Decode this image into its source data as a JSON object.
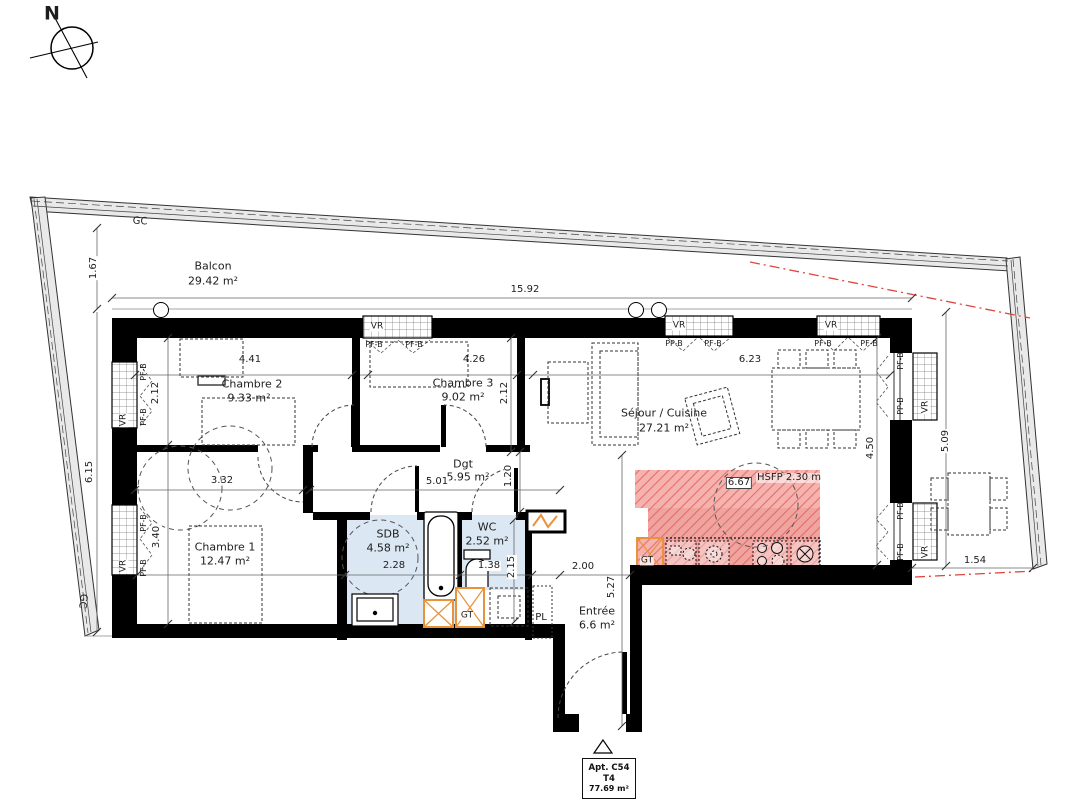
{
  "title_block": {
    "apartment": "Apt. C54",
    "unit_type": "T4",
    "total_area": "77.69 m²"
  },
  "colors": {
    "wall": "#000000",
    "wet_room_fill": "#dbe7f3",
    "kitchen_zone_fill": "#f5b2ae",
    "kitchen_hatch_line": "#e2716c",
    "technical_orange": "#e8923a",
    "alignment_red": "#e0443e",
    "balcony_band_fill": "#e9e9e9"
  },
  "rooms": [
    {
      "name": "Balcon",
      "area": "29.42 m²"
    },
    {
      "name": "Chambre 2",
      "area": "9.33 m²"
    },
    {
      "name": "Chambre 3",
      "area": "9.02 m²"
    },
    {
      "name": "Séjour / Cuisine",
      "area": "27.21 m²"
    },
    {
      "name": "Chambre 1",
      "area": "12.47 m²"
    },
    {
      "name": "Dgt",
      "area": "5.95 m²"
    },
    {
      "name": "SDB",
      "area": "4.58 m²"
    },
    {
      "name": "WC",
      "area": "2.52 m²"
    },
    {
      "name": "Entrée",
      "area": "6.6 m²"
    }
  ],
  "labels": [
    {
      "id": "north",
      "t": "N",
      "x": 52,
      "y": 14,
      "fs": 19,
      "bold": true
    },
    {
      "id": "gc-top",
      "t": "GC",
      "x": 140,
      "y": 222,
      "fs": 10,
      "rot": 4
    },
    {
      "id": "gc-left",
      "t": "GC",
      "x": 82,
      "y": 601,
      "fs": 10,
      "rot": 97
    },
    {
      "id": "balcon-name",
      "t": "Balcon",
      "x": 213,
      "y": 266,
      "fs": 11
    },
    {
      "id": "balcon-area",
      "t": "29.42 m²",
      "x": 213,
      "y": 281,
      "fs": 11
    },
    {
      "id": "dim-1-67",
      "t": "1.67",
      "x": 94,
      "y": 268,
      "fs": 10,
      "rot": -90,
      "bg": "#fff"
    },
    {
      "id": "dim-15-92",
      "t": "15.92",
      "x": 525,
      "y": 290,
      "fs": 10
    },
    {
      "id": "dim-6-15",
      "t": "6.15",
      "x": 90,
      "y": 472,
      "fs": 10,
      "rot": -90,
      "bg": "#fff"
    },
    {
      "id": "vr-top-1",
      "t": "VR",
      "x": 377,
      "y": 327,
      "fs": 9,
      "bg": "#fff"
    },
    {
      "id": "vr-top-2",
      "t": "VR",
      "x": 679,
      "y": 326,
      "fs": 9,
      "bg": "#fff"
    },
    {
      "id": "vr-top-3",
      "t": "VR",
      "x": 831,
      "y": 326,
      "fs": 9,
      "bg": "#fff"
    },
    {
      "id": "vr-left-1",
      "t": "VR",
      "x": 124,
      "y": 420,
      "fs": 9,
      "rot": -90,
      "bg": "#fff"
    },
    {
      "id": "vr-left-2",
      "t": "VR",
      "x": 124,
      "y": 566,
      "fs": 9,
      "rot": -90,
      "bg": "#fff"
    },
    {
      "id": "vr-right-1",
      "t": "VR",
      "x": 926,
      "y": 407,
      "fs": 9,
      "rot": -90,
      "bg": "#fff"
    },
    {
      "id": "vr-right-2",
      "t": "VR",
      "x": 926,
      "y": 552,
      "fs": 9,
      "rot": -90,
      "bg": "#fff"
    },
    {
      "id": "pfb-t1a",
      "t": "PF-B",
      "x": 374,
      "y": 345,
      "fs": 8
    },
    {
      "id": "pfb-t1b",
      "t": "PF-B",
      "x": 414,
      "y": 345,
      "fs": 8
    },
    {
      "id": "ppb-t2a",
      "t": "PP-B",
      "x": 674,
      "y": 344,
      "fs": 8
    },
    {
      "id": "pfb-t2b",
      "t": "PF-B",
      "x": 713,
      "y": 344,
      "fs": 8
    },
    {
      "id": "pfb-t3a",
      "t": "PF-B",
      "x": 823,
      "y": 344,
      "fs": 8
    },
    {
      "id": "pfb-t3b",
      "t": "PF-B",
      "x": 869,
      "y": 344,
      "fs": 8
    },
    {
      "id": "pfb-l1a",
      "t": "PF-B",
      "x": 144,
      "y": 372,
      "fs": 8,
      "rot": -90
    },
    {
      "id": "pfb-l1b",
      "t": "PF-B",
      "x": 144,
      "y": 417,
      "fs": 8,
      "rot": -90
    },
    {
      "id": "pfb-l2a",
      "t": "PF-B",
      "x": 144,
      "y": 523,
      "fs": 8,
      "rot": -90
    },
    {
      "id": "pfb-l2b",
      "t": "PF-B",
      "x": 144,
      "y": 568,
      "fs": 8,
      "rot": -90
    },
    {
      "id": "pfb-r1a",
      "t": "PF-B",
      "x": 901,
      "y": 361,
      "fs": 8,
      "rot": -90
    },
    {
      "id": "ppb-r1b",
      "t": "PP-B",
      "x": 901,
      "y": 406,
      "fs": 8,
      "rot": -90
    },
    {
      "id": "pfb-r2a",
      "t": "PF-B",
      "x": 901,
      "y": 511,
      "fs": 8,
      "rot": -90
    },
    {
      "id": "pfb-r2b",
      "t": "PF-B",
      "x": 901,
      "y": 552,
      "fs": 8,
      "rot": -90
    },
    {
      "id": "ch2-name",
      "t": "Chambre 2",
      "x": 252,
      "y": 384,
      "fs": 11
    },
    {
      "id": "ch2-area",
      "t": "9.33 m²",
      "x": 249,
      "y": 398,
      "fs": 11
    },
    {
      "id": "dim-4-41",
      "t": "4.41",
      "x": 250,
      "y": 360,
      "fs": 10
    },
    {
      "id": "dim-2-12a",
      "t": "2.12",
      "x": 156,
      "y": 393,
      "fs": 10,
      "rot": -90
    },
    {
      "id": "ch3-name",
      "t": "Chambre 3",
      "x": 463,
      "y": 383,
      "fs": 11
    },
    {
      "id": "ch3-area",
      "t": "9.02 m²",
      "x": 463,
      "y": 397,
      "fs": 11
    },
    {
      "id": "dim-4-26",
      "t": "4.26",
      "x": 474,
      "y": 360,
      "fs": 10
    },
    {
      "id": "dim-2-12b",
      "t": "2.12",
      "x": 505,
      "y": 393,
      "fs": 10,
      "rot": -90
    },
    {
      "id": "sejour-name",
      "t": "Séjour / Cuisine",
      "x": 664,
      "y": 413,
      "fs": 11
    },
    {
      "id": "sejour-area",
      "t": "27.21 m²",
      "x": 664,
      "y": 428,
      "fs": 11
    },
    {
      "id": "dim-6-23",
      "t": "6.23",
      "x": 750,
      "y": 360,
      "fs": 10
    },
    {
      "id": "dim-4-50",
      "t": "4.50",
      "x": 871,
      "y": 448,
      "fs": 10,
      "rot": -90,
      "bg": "#fff"
    },
    {
      "id": "ch1-name",
      "t": "Chambre 1",
      "x": 225,
      "y": 547,
      "fs": 11
    },
    {
      "id": "ch1-area",
      "t": "12.47 m²",
      "x": 225,
      "y": 561,
      "fs": 11
    },
    {
      "id": "dim-3-32",
      "t": "3.32",
      "x": 222,
      "y": 481,
      "fs": 10
    },
    {
      "id": "dim-3-40",
      "t": "3.40",
      "x": 157,
      "y": 537,
      "fs": 10,
      "rot": -90,
      "bg": "#fff"
    },
    {
      "id": "dgt-name",
      "t": "Dgt",
      "x": 463,
      "y": 464,
      "fs": 11
    },
    {
      "id": "dgt-area",
      "t": "5.95 m²",
      "x": 468,
      "y": 477,
      "fs": 11
    },
    {
      "id": "dim-5-01",
      "t": "5.01",
      "x": 437,
      "y": 482,
      "fs": 10,
      "bg": "#fff"
    },
    {
      "id": "dim-1-20",
      "t": "1.20",
      "x": 509,
      "y": 476,
      "fs": 10,
      "rot": -90,
      "bg": "#fff"
    },
    {
      "id": "sdb-name",
      "t": "SDB",
      "x": 388,
      "y": 534,
      "fs": 11
    },
    {
      "id": "sdb-area",
      "t": "4.58 m²",
      "x": 388,
      "y": 548,
      "fs": 11
    },
    {
      "id": "dim-2-28",
      "t": "2.28",
      "x": 394,
      "y": 566,
      "fs": 10
    },
    {
      "id": "wc-name",
      "t": "WC",
      "x": 487,
      "y": 527,
      "fs": 11
    },
    {
      "id": "wc-area",
      "t": "2.52 m²",
      "x": 487,
      "y": 541,
      "fs": 11
    },
    {
      "id": "dim-1-38",
      "t": "1.38",
      "x": 489,
      "y": 566,
      "fs": 10,
      "bg": "#fff"
    },
    {
      "id": "dim-2-15",
      "t": "2.15",
      "x": 512,
      "y": 567,
      "fs": 10,
      "rot": -90,
      "bg": "#fff"
    },
    {
      "id": "entree-name",
      "t": "Entrée",
      "x": 597,
      "y": 611,
      "fs": 11
    },
    {
      "id": "entree-area",
      "t": "6.6 m²",
      "x": 597,
      "y": 625,
      "fs": 11
    },
    {
      "id": "dim-2-00",
      "t": "2.00",
      "x": 583,
      "y": 567,
      "fs": 10
    },
    {
      "id": "dim-5-27",
      "t": "5.27",
      "x": 612,
      "y": 587,
      "fs": 10,
      "rot": -90
    },
    {
      "id": "pl",
      "t": "PL",
      "x": 541,
      "y": 618,
      "fs": 10
    },
    {
      "id": "gt-bath",
      "t": "GT",
      "x": 467,
      "y": 616,
      "fs": 9,
      "bg": "rgba(255,255,255,0.8)"
    },
    {
      "id": "gt-kitchen",
      "t": "GT",
      "x": 647,
      "y": 561,
      "fs": 9,
      "bg": "rgba(255,255,255,0.7)"
    },
    {
      "id": "dim-6-67",
      "t": "6.67",
      "x": 739,
      "y": 483,
      "fs": 10,
      "bg": "#fff",
      "border": true
    },
    {
      "id": "hsfp",
      "t": "HSFP 2.30 m",
      "x": 789,
      "y": 478,
      "fs": 10,
      "bg": "rgba(255,255,255,0.55)"
    },
    {
      "id": "dim-5-09",
      "t": "5.09",
      "x": 946,
      "y": 441,
      "fs": 10,
      "rot": -90,
      "bg": "#fff"
    },
    {
      "id": "dim-1-54",
      "t": "1.54",
      "x": 975,
      "y": 561,
      "fs": 10,
      "bg": "#fff"
    }
  ]
}
